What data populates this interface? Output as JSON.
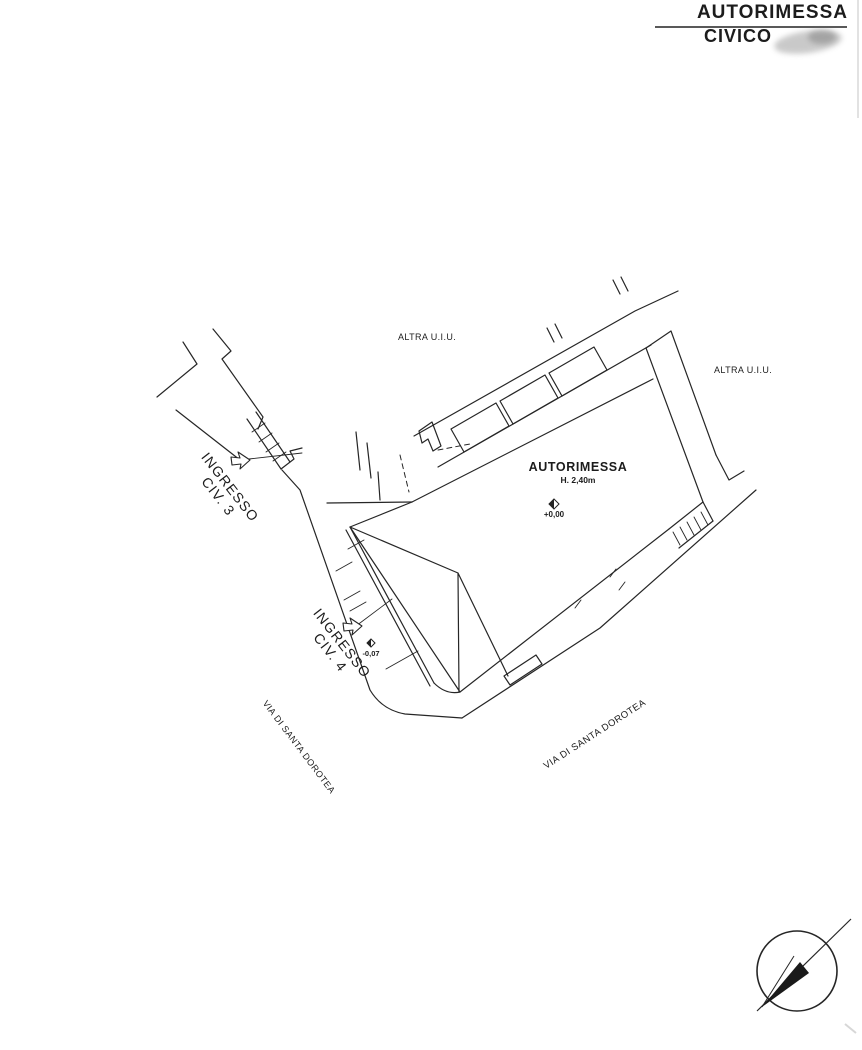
{
  "title": {
    "line1": "AUTORIMESSA",
    "line2": "CIVICO"
  },
  "labels": {
    "neighbor_top": "ALTRA U.I.U.",
    "neighbor_right": "ALTRA U.I.U.",
    "hall": "AUTORIMESSA",
    "hall_height": "H. 2,40m",
    "level_main": "+0,00",
    "level_entrance4": "-0,07",
    "entrance3": {
      "line1": "INGRESSO",
      "line2": "CIV. 3"
    },
    "entrance4": {
      "line1": "INGRESSO",
      "line2": "CIV. 4"
    },
    "street_left": "VIA DI SANTA DOROTEA",
    "street_right": "VIA DI SANTA DOROTEA"
  },
  "icons": {
    "north_arrow": "north-arrow",
    "entrance_arrow": "entrance-arrow",
    "level_marker": "level-marker-diamond"
  },
  "colors": {
    "ink": "#222222",
    "paper": "#ffffff",
    "smudge_gray": "#8a8a8a"
  }
}
